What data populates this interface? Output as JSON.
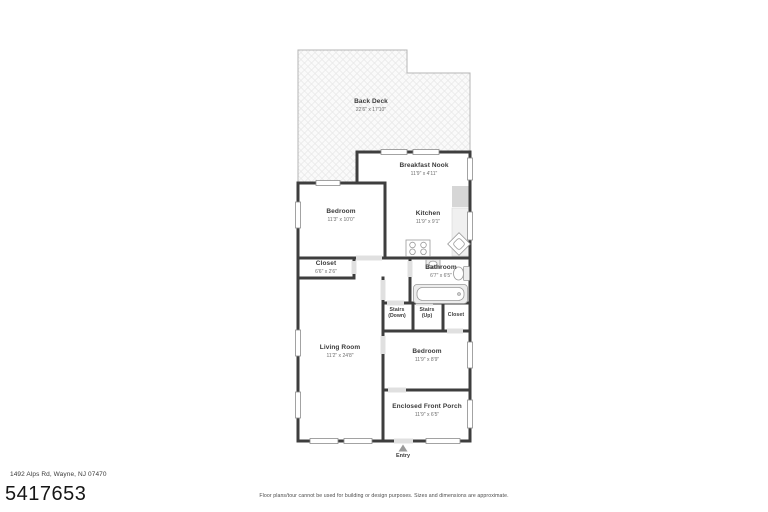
{
  "listing": {
    "mls_number": "5417653",
    "address": "1492 Alps Rd, Wayne, NJ 07470"
  },
  "footer": {
    "disclaimer": "Floor plans/tour cannot be used for building or design purposes. Sizes and dimensions are approximate."
  },
  "entry": {
    "label": "Entry"
  },
  "rooms": {
    "back_deck": {
      "name": "Back Deck",
      "dims": "22'6\" x 17'10\""
    },
    "breakfast_nook": {
      "name": "Breakfast Nook",
      "dims": "11'9\" x 4'11\""
    },
    "bedroom_upper": {
      "name": "Bedroom",
      "dims": "11'3\" x 10'0\""
    },
    "kitchen": {
      "name": "Kitchen",
      "dims": "11'9\" x 9'1\""
    },
    "closet_upper": {
      "name": "Closet",
      "dims": "6'6\" x 2'6\""
    },
    "bathroom": {
      "name": "Bathroom",
      "dims": "6'7\" x 6'5\""
    },
    "stairs_down": {
      "name": "Stairs",
      "dims": "(Down)"
    },
    "stairs_up": {
      "name": "Stairs",
      "dims": "(Up)"
    },
    "closet_hall": {
      "name": "Closet",
      "dims": ""
    },
    "living_room": {
      "name": "Living Room",
      "dims": "11'2\" x 24'8\""
    },
    "bedroom_lower": {
      "name": "Bedroom",
      "dims": "11'9\" x 8'9\""
    },
    "enclosed_front_porch": {
      "name": "Enclosed Front Porch",
      "dims": "11'9\" x 6'5\""
    }
  },
  "colors": {
    "wall": "#3e3e3e",
    "window_frame": "#8c8c8c",
    "deck_outline": "#b5b5b5",
    "deck_hatch": "#e7e7e7",
    "fixture_stroke": "#999999",
    "door_sill": "#e0e0e0",
    "room_text": "#3a3a3a",
    "dim_text": "#6e6e6e"
  }
}
